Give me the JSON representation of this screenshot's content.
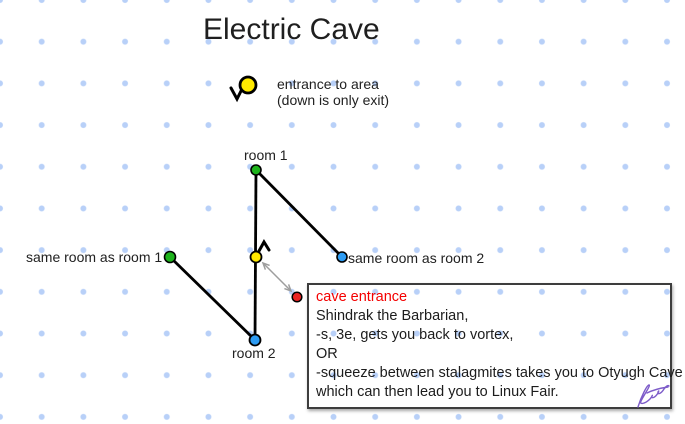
{
  "title": "Electric Cave",
  "legend": {
    "line1": "entrance to area",
    "line2": "(down is only exit)",
    "icon": "down-chevron-icon"
  },
  "labels": {
    "room1": "room 1",
    "room2": "room 2",
    "same_as_room1": "same room as room 1",
    "same_as_room2": "same room as room 2"
  },
  "icons": {
    "vortex_exit": "up-chevron-icon",
    "vortex_to_cave": "double-headed-arrow-icon"
  },
  "note_box": {
    "heading": "cave entrance",
    "lines": [
      "Shindrak the Barbarian,",
      "-s, 3e, gets you back to vortex,",
      "OR",
      "-squeeze between stalagmites takes you to Otyugh Cave",
      "which can then lead you to Linux Fair."
    ]
  },
  "colors": {
    "grid_dot": "#b8d0f8",
    "room_green": "#1db31c",
    "room_blue": "#2d9cf4",
    "entrance_yellow": "#ffe900",
    "cave_red": "#ea2424",
    "heading_red": "#f40000",
    "edge_black": "#000000",
    "arrow_gray": "#9e9e9e",
    "signature_purple": "#7d5cc9"
  }
}
